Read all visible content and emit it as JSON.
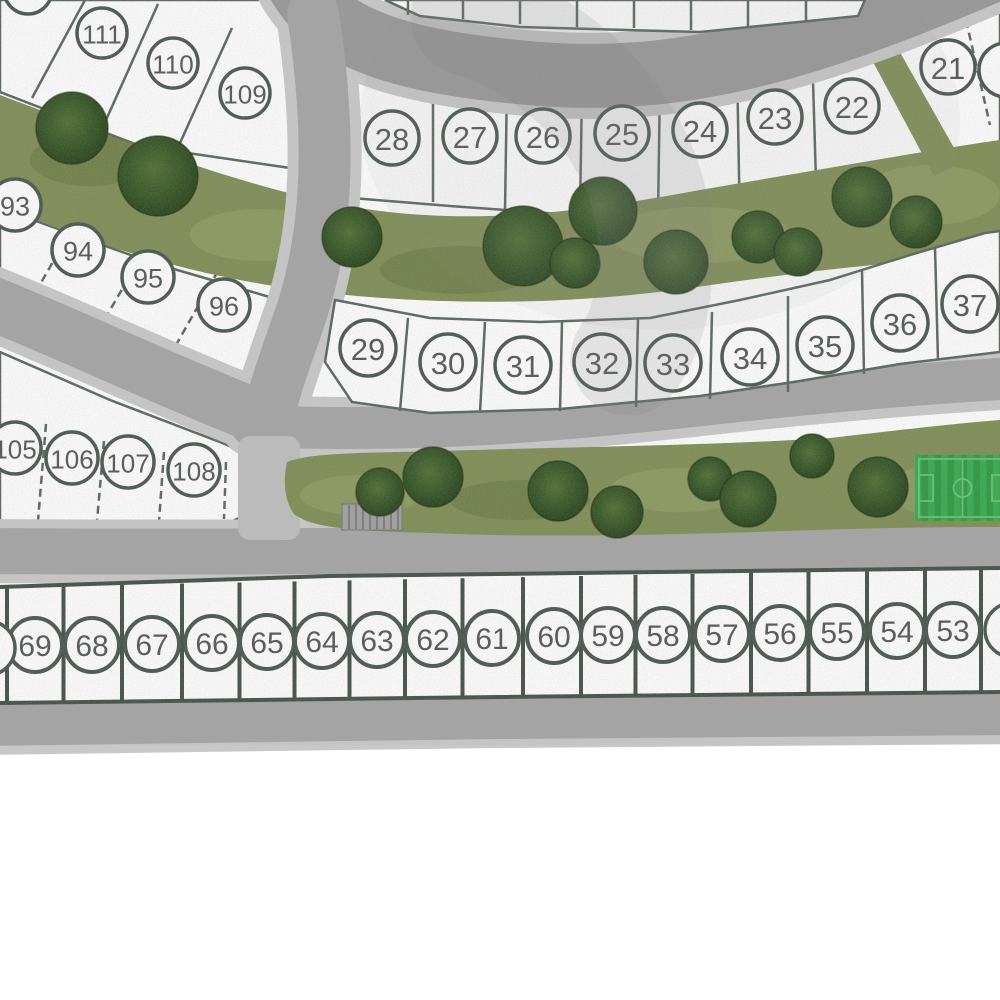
{
  "map": {
    "description": "Residential subdivision site plan with numbered lots, curving streets, landscaped green belts with trees, and a soccer field",
    "colors": {
      "lot_fill": "#ffffff",
      "lot_line": "#57625a",
      "circle_stroke": "#44524a",
      "number": "#4f534f",
      "bottom_line": "#3f4b43",
      "road": "#a3a3a3",
      "road_dark": "#969696",
      "sidewalk": "#c8c8c8",
      "green": "#7c8b50",
      "green_light": "#94a263",
      "green_dark": "#5f7038",
      "tree_light": "#4a6a2e",
      "tree_mid": "#30511f",
      "tree_dark": "#1f3a12",
      "field_dark": "#27963b",
      "field_light": "#31a849",
      "field_line": "#62c472",
      "structure_gray": "#9e9e9e"
    },
    "lot_groups": [
      {
        "id": "top-left-row",
        "radius": 25,
        "font_size": 26,
        "stroke_width": 3.5,
        "lots": [
          {
            "label": "111",
            "x": 102,
            "y": 33
          },
          {
            "label": "110",
            "x": 173,
            "y": 63
          },
          {
            "label": "109",
            "x": 245,
            "y": 93
          }
        ]
      },
      {
        "id": "row-20s",
        "radius": 27,
        "font_size": 31,
        "stroke_width": 3.5,
        "lots": [
          {
            "label": "28",
            "x": 392,
            "y": 138
          },
          {
            "label": "27",
            "x": 470,
            "y": 136
          },
          {
            "label": "26",
            "x": 543,
            "y": 136
          },
          {
            "label": "25",
            "x": 622,
            "y": 133
          },
          {
            "label": "24",
            "x": 700,
            "y": 130
          },
          {
            "label": "23",
            "x": 775,
            "y": 117
          },
          {
            "label": "22",
            "x": 852,
            "y": 106
          },
          {
            "label": "21",
            "x": 948,
            "y": 67
          }
        ]
      },
      {
        "id": "row-90s",
        "radius": 26,
        "font_size": 27,
        "stroke_width": 3.5,
        "lots": [
          {
            "label": "93",
            "x": 15,
            "y": 205
          },
          {
            "label": "94",
            "x": 78,
            "y": 250
          },
          {
            "label": "95",
            "x": 148,
            "y": 277
          },
          {
            "label": "96",
            "x": 224,
            "y": 305
          }
        ]
      },
      {
        "id": "row-30s",
        "radius": 28,
        "font_size": 31,
        "stroke_width": 3.5,
        "lots": [
          {
            "label": "29",
            "x": 368,
            "y": 348
          },
          {
            "label": "30",
            "x": 448,
            "y": 362
          },
          {
            "label": "31",
            "x": 523,
            "y": 365
          },
          {
            "label": "32",
            "x": 602,
            "y": 362
          },
          {
            "label": "33",
            "x": 673,
            "y": 363
          },
          {
            "label": "34",
            "x": 750,
            "y": 357
          },
          {
            "label": "35",
            "x": 825,
            "y": 345
          },
          {
            "label": "36",
            "x": 900,
            "y": 323
          },
          {
            "label": "37",
            "x": 970,
            "y": 304
          }
        ]
      },
      {
        "id": "row-100s",
        "radius": 26,
        "font_size": 26,
        "stroke_width": 3.5,
        "lots": [
          {
            "label": "105",
            "x": 15,
            "y": 448
          },
          {
            "label": "106",
            "x": 72,
            "y": 458
          },
          {
            "label": "107",
            "x": 128,
            "y": 462
          },
          {
            "label": "108",
            "x": 194,
            "y": 470
          }
        ]
      },
      {
        "id": "bottom-row",
        "radius": 27,
        "font_size": 30,
        "stroke_width": 4,
        "lots": [
          {
            "label": "69",
            "x": 35,
            "y": 645
          },
          {
            "label": "68",
            "x": 92,
            "y": 645
          },
          {
            "label": "67",
            "x": 152,
            "y": 644
          },
          {
            "label": "66",
            "x": 212,
            "y": 643
          },
          {
            "label": "65",
            "x": 267,
            "y": 642
          },
          {
            "label": "64",
            "x": 322,
            "y": 641
          },
          {
            "label": "63",
            "x": 377,
            "y": 640
          },
          {
            "label": "62",
            "x": 433,
            "y": 639
          },
          {
            "label": "61",
            "x": 492,
            "y": 638
          },
          {
            "label": "60",
            "x": 554,
            "y": 636
          },
          {
            "label": "59",
            "x": 608,
            "y": 635
          },
          {
            "label": "58",
            "x": 663,
            "y": 635
          },
          {
            "label": "57",
            "x": 722,
            "y": 634
          },
          {
            "label": "56",
            "x": 780,
            "y": 633
          },
          {
            "label": "55",
            "x": 837,
            "y": 632
          },
          {
            "label": "54",
            "x": 897,
            "y": 631
          },
          {
            "label": "53",
            "x": 953,
            "y": 630
          }
        ]
      }
    ],
    "partial_circles": [
      {
        "x": 28,
        "y": -10,
        "r": 24
      },
      {
        "x": 1006,
        "y": 70,
        "r": 27
      },
      {
        "x": -12,
        "y": 648,
        "r": 27
      },
      {
        "x": 1012,
        "y": 630,
        "r": 27
      }
    ],
    "trees": {
      "upper_belt": [
        [
          72,
          128,
          36
        ],
        [
          158,
          176,
          40
        ],
        [
          352,
          237,
          30
        ],
        [
          523,
          246,
          40
        ],
        [
          575,
          263,
          25
        ],
        [
          603,
          211,
          34
        ],
        [
          676,
          262,
          32
        ],
        [
          758,
          237,
          26
        ],
        [
          798,
          252,
          24
        ],
        [
          862,
          197,
          30
        ],
        [
          916,
          222,
          26
        ]
      ],
      "lower_belt": [
        [
          380,
          492,
          24
        ],
        [
          433,
          477,
          30
        ],
        [
          558,
          491,
          30
        ],
        [
          617,
          512,
          26
        ],
        [
          710,
          479,
          22
        ],
        [
          748,
          499,
          28
        ],
        [
          812,
          456,
          22
        ],
        [
          878,
          487,
          30
        ]
      ]
    },
    "sports_field": {
      "x": 915,
      "y": 455,
      "width": 95,
      "height": 66
    },
    "structure": {
      "x": 342,
      "y": 504,
      "width": 60,
      "height": 26
    }
  }
}
